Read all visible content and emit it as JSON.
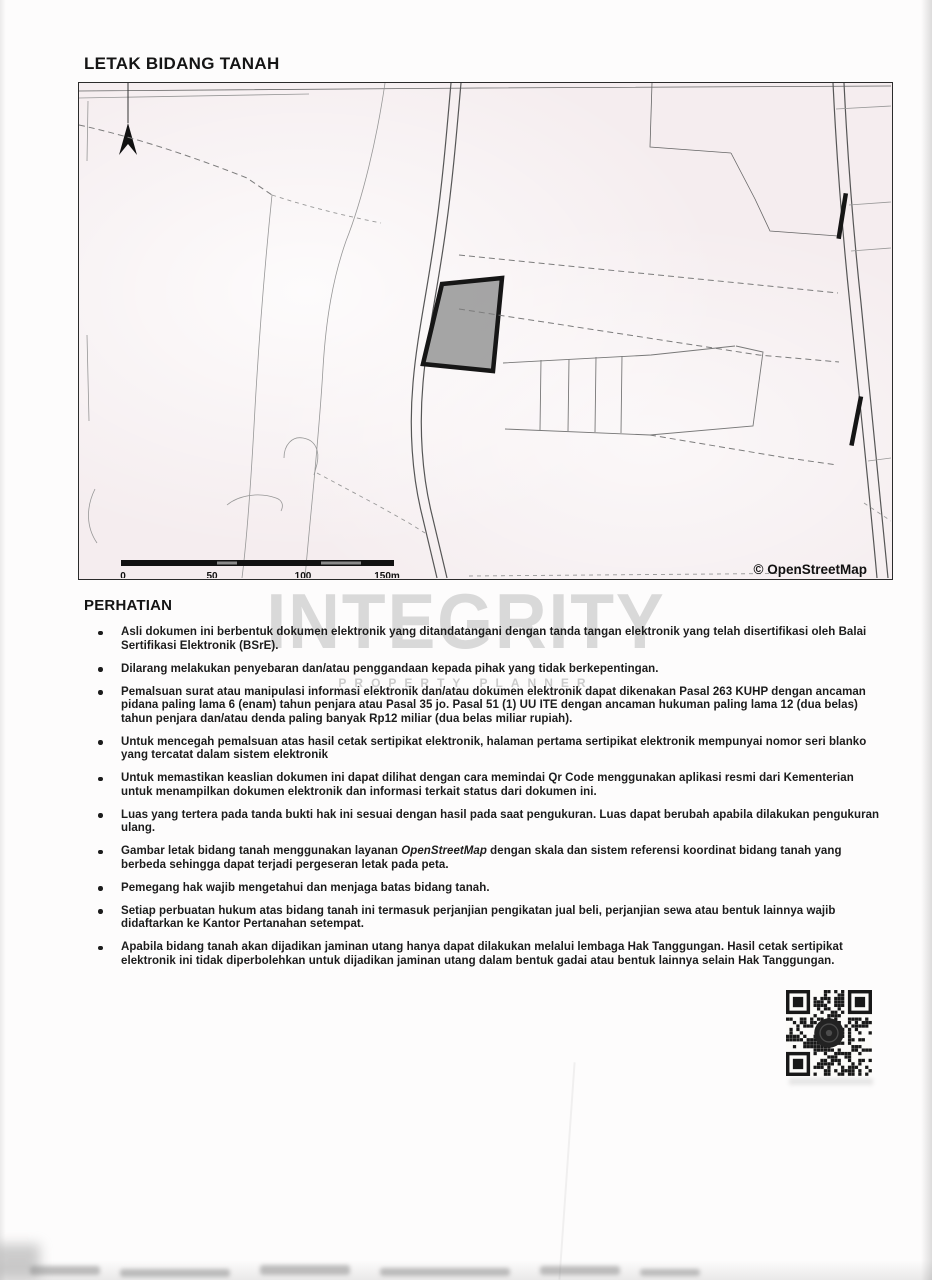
{
  "document": {
    "title": "LETAK BIDANG TANAH"
  },
  "map": {
    "attribution": "© OpenStreetMap",
    "scale_ticks": [
      "0",
      "50",
      "100",
      "150m"
    ]
  },
  "watermark": {
    "line1": "INTEGRITY",
    "line2": "PROPERTY PLANNER"
  },
  "notice": {
    "heading": "PERHATIAN",
    "bullets": [
      "Asli dokumen ini berbentuk dokumen elektronik yang ditandatangani dengan tanda tangan elektronik yang telah disertifikasi oleh Balai Sertifikasi Elektronik (BSrE).",
      "Dilarang melakukan penyebaran dan/atau penggandaan kepada pihak yang tidak berkepentingan.",
      "Pemalsuan surat atau manipulasi informasi elektronik dan/atau dokumen elektronik dapat dikenakan Pasal 263 KUHP dengan ancaman pidana paling lama 6 (enam) tahun penjara atau Pasal 35 jo. Pasal 51 (1) UU ITE dengan ancaman hukuman paling lama 12 (dua belas) tahun penjara dan/atau denda paling banyak Rp12 miliar (dua belas miliar rupiah).",
      "Untuk mencegah pemalsuan atas hasil cetak sertipikat elektronik, halaman pertama sertipikat elektronik mempunyai nomor seri blanko yang tercatat dalam sistem elektronik",
      "Untuk memastikan keaslian dokumen ini dapat dilihat dengan cara memindai Qr Code menggunakan aplikasi resmi dari Kementerian untuk menampilkan dokumen elektronik dan informasi terkait status dari dokumen ini.",
      "Luas yang tertera pada tanda bukti hak ini sesuai dengan hasil pada saat pengukuran. Luas dapat berubah apabila dilakukan pengukuran ulang.",
      {
        "pre": "Gambar letak bidang tanah menggunakan layanan ",
        "italic": "OpenStreetMap",
        "post": " dengan skala dan sistem referensi koordinat bidang tanah yang berbeda sehingga dapat terjadi pergeseran letak pada peta."
      },
      "Pemegang hak wajib mengetahui dan menjaga batas bidang tanah.",
      "Setiap perbuatan hukum atas bidang tanah ini termasuk perjanjian pengikatan jual beli, perjanjian sewa atau bentuk lainnya wajib didaftarkan ke Kantor Pertanahan setempat.",
      "Apabila bidang tanah akan dijadikan jaminan utang hanya dapat dilakukan melalui lembaga Hak Tanggungan. Hasil cetak sertipikat elektronik ini tidak diperbolehkan untuk dijadikan jaminan utang dalam bentuk gadai atau bentuk lainnya selain Hak Tanggungan."
    ]
  },
  "colors": {
    "ink": "#1a1a1a",
    "map_background": "#f5edef",
    "parcel_fill": "#9b9b9b",
    "watermark_gray": "#bdbdbd"
  }
}
